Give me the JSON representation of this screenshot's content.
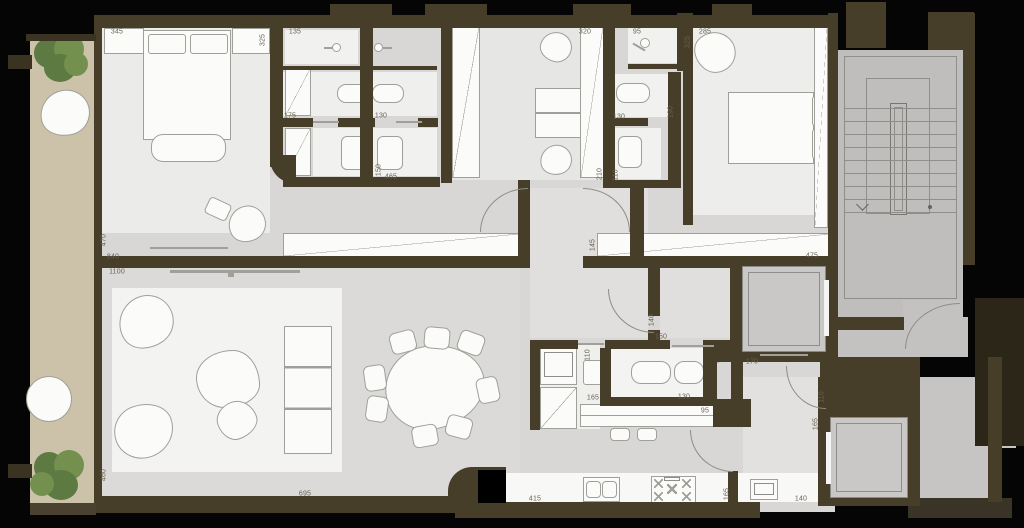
{
  "document": {
    "type": "apartment floor plan",
    "description": "Architectural plan of an apartment with two bedrooms, bathrooms, dressing room, living-dining area, kitchen, balcony, stairwell and two elevators. All visible text is dimension annotations (cm)."
  },
  "colors": {
    "background": "#050505",
    "wall": "#463e29",
    "wall_dark": "#2b2618",
    "wall_slab": "#4a4131",
    "floor": "#d8d7d5",
    "floor_light": "#ebebe9",
    "floor_white": "#f3f3f1",
    "stairs": "#bfbebc",
    "elevator_car": "#c9c8c6",
    "balcony": "#cbc2a9",
    "plant": "#5d7a43",
    "plant_light": "#73904f",
    "furniture_fill": "#fbfbf9",
    "furniture_line": "#a0a09a",
    "arc_line": "#8d8d88",
    "label_text": "#6a6250"
  },
  "dimension_labels": [
    {
      "text": "345",
      "x": 117,
      "y": 32,
      "vertical": false
    },
    {
      "text": "325",
      "x": 263,
      "y": 40,
      "vertical": true
    },
    {
      "text": "135",
      "x": 295,
      "y": 32,
      "vertical": false
    },
    {
      "text": "175",
      "x": 290,
      "y": 116,
      "vertical": false
    },
    {
      "text": "130",
      "x": 381,
      "y": 116,
      "vertical": false
    },
    {
      "text": "150",
      "x": 379,
      "y": 170,
      "vertical": true
    },
    {
      "text": "465",
      "x": 391,
      "y": 177,
      "vertical": false
    },
    {
      "text": "320",
      "x": 585,
      "y": 32,
      "vertical": false
    },
    {
      "text": "95",
      "x": 637,
      "y": 32,
      "vertical": false
    },
    {
      "text": "325",
      "x": 688,
      "y": 42,
      "vertical": true
    },
    {
      "text": "285",
      "x": 705,
      "y": 32,
      "vertical": false
    },
    {
      "text": "130",
      "x": 619,
      "y": 117,
      "vertical": false
    },
    {
      "text": "190",
      "x": 671,
      "y": 112,
      "vertical": true
    },
    {
      "text": "210",
      "x": 600,
      "y": 174,
      "vertical": true
    },
    {
      "text": "110",
      "x": 616,
      "y": 175,
      "vertical": true
    },
    {
      "text": "470",
      "x": 104,
      "y": 240,
      "vertical": true
    },
    {
      "text": "840",
      "x": 113,
      "y": 257,
      "vertical": false
    },
    {
      "text": "145",
      "x": 593,
      "y": 245,
      "vertical": true
    },
    {
      "text": "475",
      "x": 812,
      "y": 256,
      "vertical": false
    },
    {
      "text": "1100",
      "x": 117,
      "y": 272,
      "vertical": false
    },
    {
      "text": "460",
      "x": 104,
      "y": 475,
      "vertical": true
    },
    {
      "text": "695",
      "x": 305,
      "y": 494,
      "vertical": false
    },
    {
      "text": "140",
      "x": 652,
      "y": 320,
      "vertical": true
    },
    {
      "text": "150",
      "x": 661,
      "y": 337,
      "vertical": false
    },
    {
      "text": "110",
      "x": 588,
      "y": 355,
      "vertical": true
    },
    {
      "text": "165",
      "x": 593,
      "y": 398,
      "vertical": false
    },
    {
      "text": "130",
      "x": 684,
      "y": 397,
      "vertical": false
    },
    {
      "text": "95",
      "x": 705,
      "y": 411,
      "vertical": false
    },
    {
      "text": "170",
      "x": 752,
      "y": 362,
      "vertical": false
    },
    {
      "text": "110",
      "x": 822,
      "y": 397,
      "vertical": true
    },
    {
      "text": "165",
      "x": 816,
      "y": 424,
      "vertical": true
    },
    {
      "text": "415",
      "x": 535,
      "y": 499,
      "vertical": false
    },
    {
      "text": "165",
      "x": 727,
      "y": 494,
      "vertical": true
    },
    {
      "text": "140",
      "x": 801,
      "y": 499,
      "vertical": false
    }
  ],
  "stairs": {
    "step_lines": 9
  }
}
